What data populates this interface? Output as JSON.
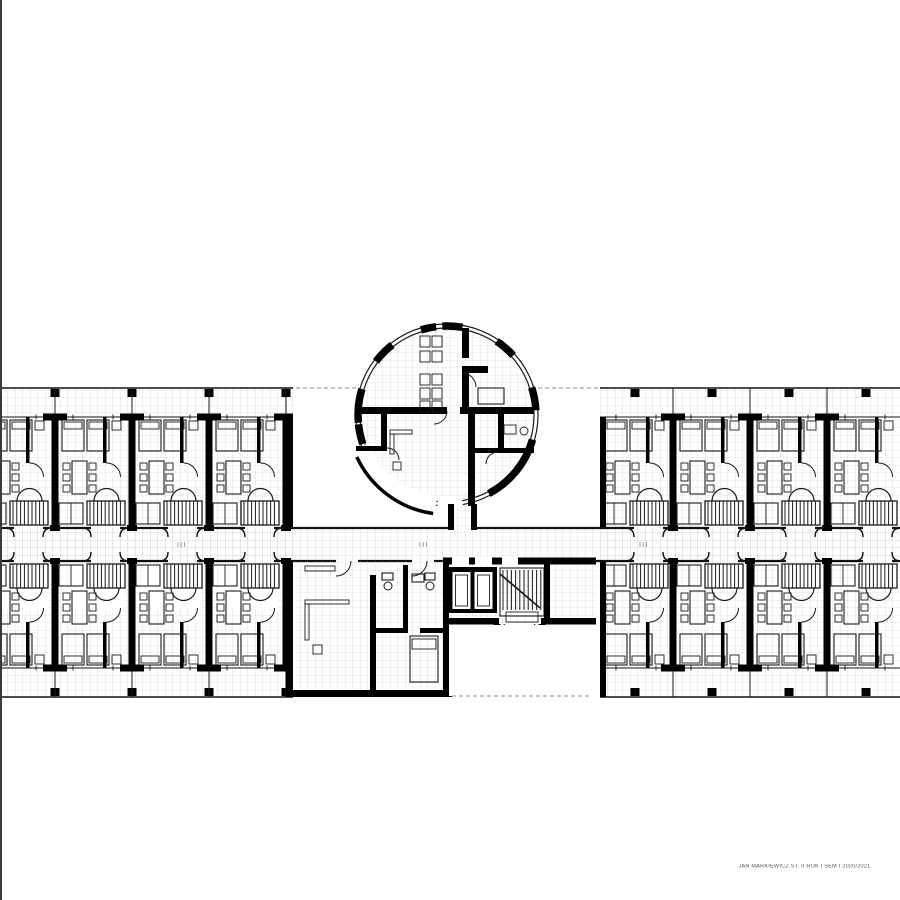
{
  "page": {
    "background": "#ffffff",
    "edge_line_color": "#3a3a3a"
  },
  "title_block": {
    "text": "JAN MARKIEWICZ ST. II ROK I SEM I 2020/2021",
    "color": "#555555"
  },
  "plan": {
    "ink": "#000000",
    "line": "#1b1b1b",
    "tile_line": "#c9c9c9",
    "dash_color": "#8f8f8f",
    "tile_pitch": 7.5,
    "bands": {
      "exterior_top": 388,
      "rooms_top": 417,
      "corridor_top": 528,
      "corridor_bottom": 561,
      "rooms_bottom": 668,
      "exterior_bottom": 697
    },
    "left_wing": {
      "clip": [
        0,
        384,
        293,
        316
      ],
      "party_walls": [
        55,
        132,
        209,
        286
      ],
      "module_starts": [
        -22,
        55,
        132,
        209
      ],
      "columns": [
        55,
        132,
        209,
        286
      ],
      "end_wall_x": 286
    },
    "right_wing": {
      "clip": [
        600,
        384,
        300,
        316
      ],
      "party_walls": [
        673,
        750,
        827
      ],
      "module_starts": [
        598,
        673,
        750,
        827
      ],
      "columns": [
        635,
        712,
        789,
        866
      ],
      "end_wall_x": 596
    },
    "module": {
      "width": 77,
      "upper_height": 111,
      "lower_height": 107,
      "entry_gap": [
        36,
        65
      ]
    },
    "corridor_ticks": [
      178,
      420,
      640
    ],
    "pavilion": {
      "cx": 447,
      "cy": 415,
      "r_outer": 91,
      "r_inner": 87,
      "pier_radius": 89,
      "piers": [
        [
          163,
          185
        ],
        [
          128,
          143
        ],
        [
          97,
          107
        ],
        [
          80,
          93
        ],
        [
          42,
          56
        ],
        [
          3,
          18
        ],
        [
          -62,
          -16
        ],
        [
          186,
          199
        ]
      ],
      "gaps": [
        [
          200,
          263
        ],
        [
          264,
          280
        ]
      ],
      "flap": [
        205,
        262
      ],
      "flap_radius": 99.5
    },
    "core": {
      "x0": 443,
      "x1": 596,
      "bay": {
        "cx": 519.5,
        "y": 624,
        "r_outer": 22.5,
        "r_inner": 15.3
      }
    },
    "common": {
      "x0": 296,
      "x1": 443
    },
    "dashes": {
      "top_y": 388,
      "top": [
        [
          296,
          356
        ],
        [
          538,
          598
        ]
      ],
      "bottom_y": 696,
      "bottom": [
        [
          452,
          592
        ]
      ]
    },
    "elements": [
      "guest-room-module",
      "balcony-strip",
      "central-corridor",
      "circular-pavilion",
      "elevator-shafts",
      "main-staircase",
      "apse-bay",
      "common-rooms"
    ]
  }
}
